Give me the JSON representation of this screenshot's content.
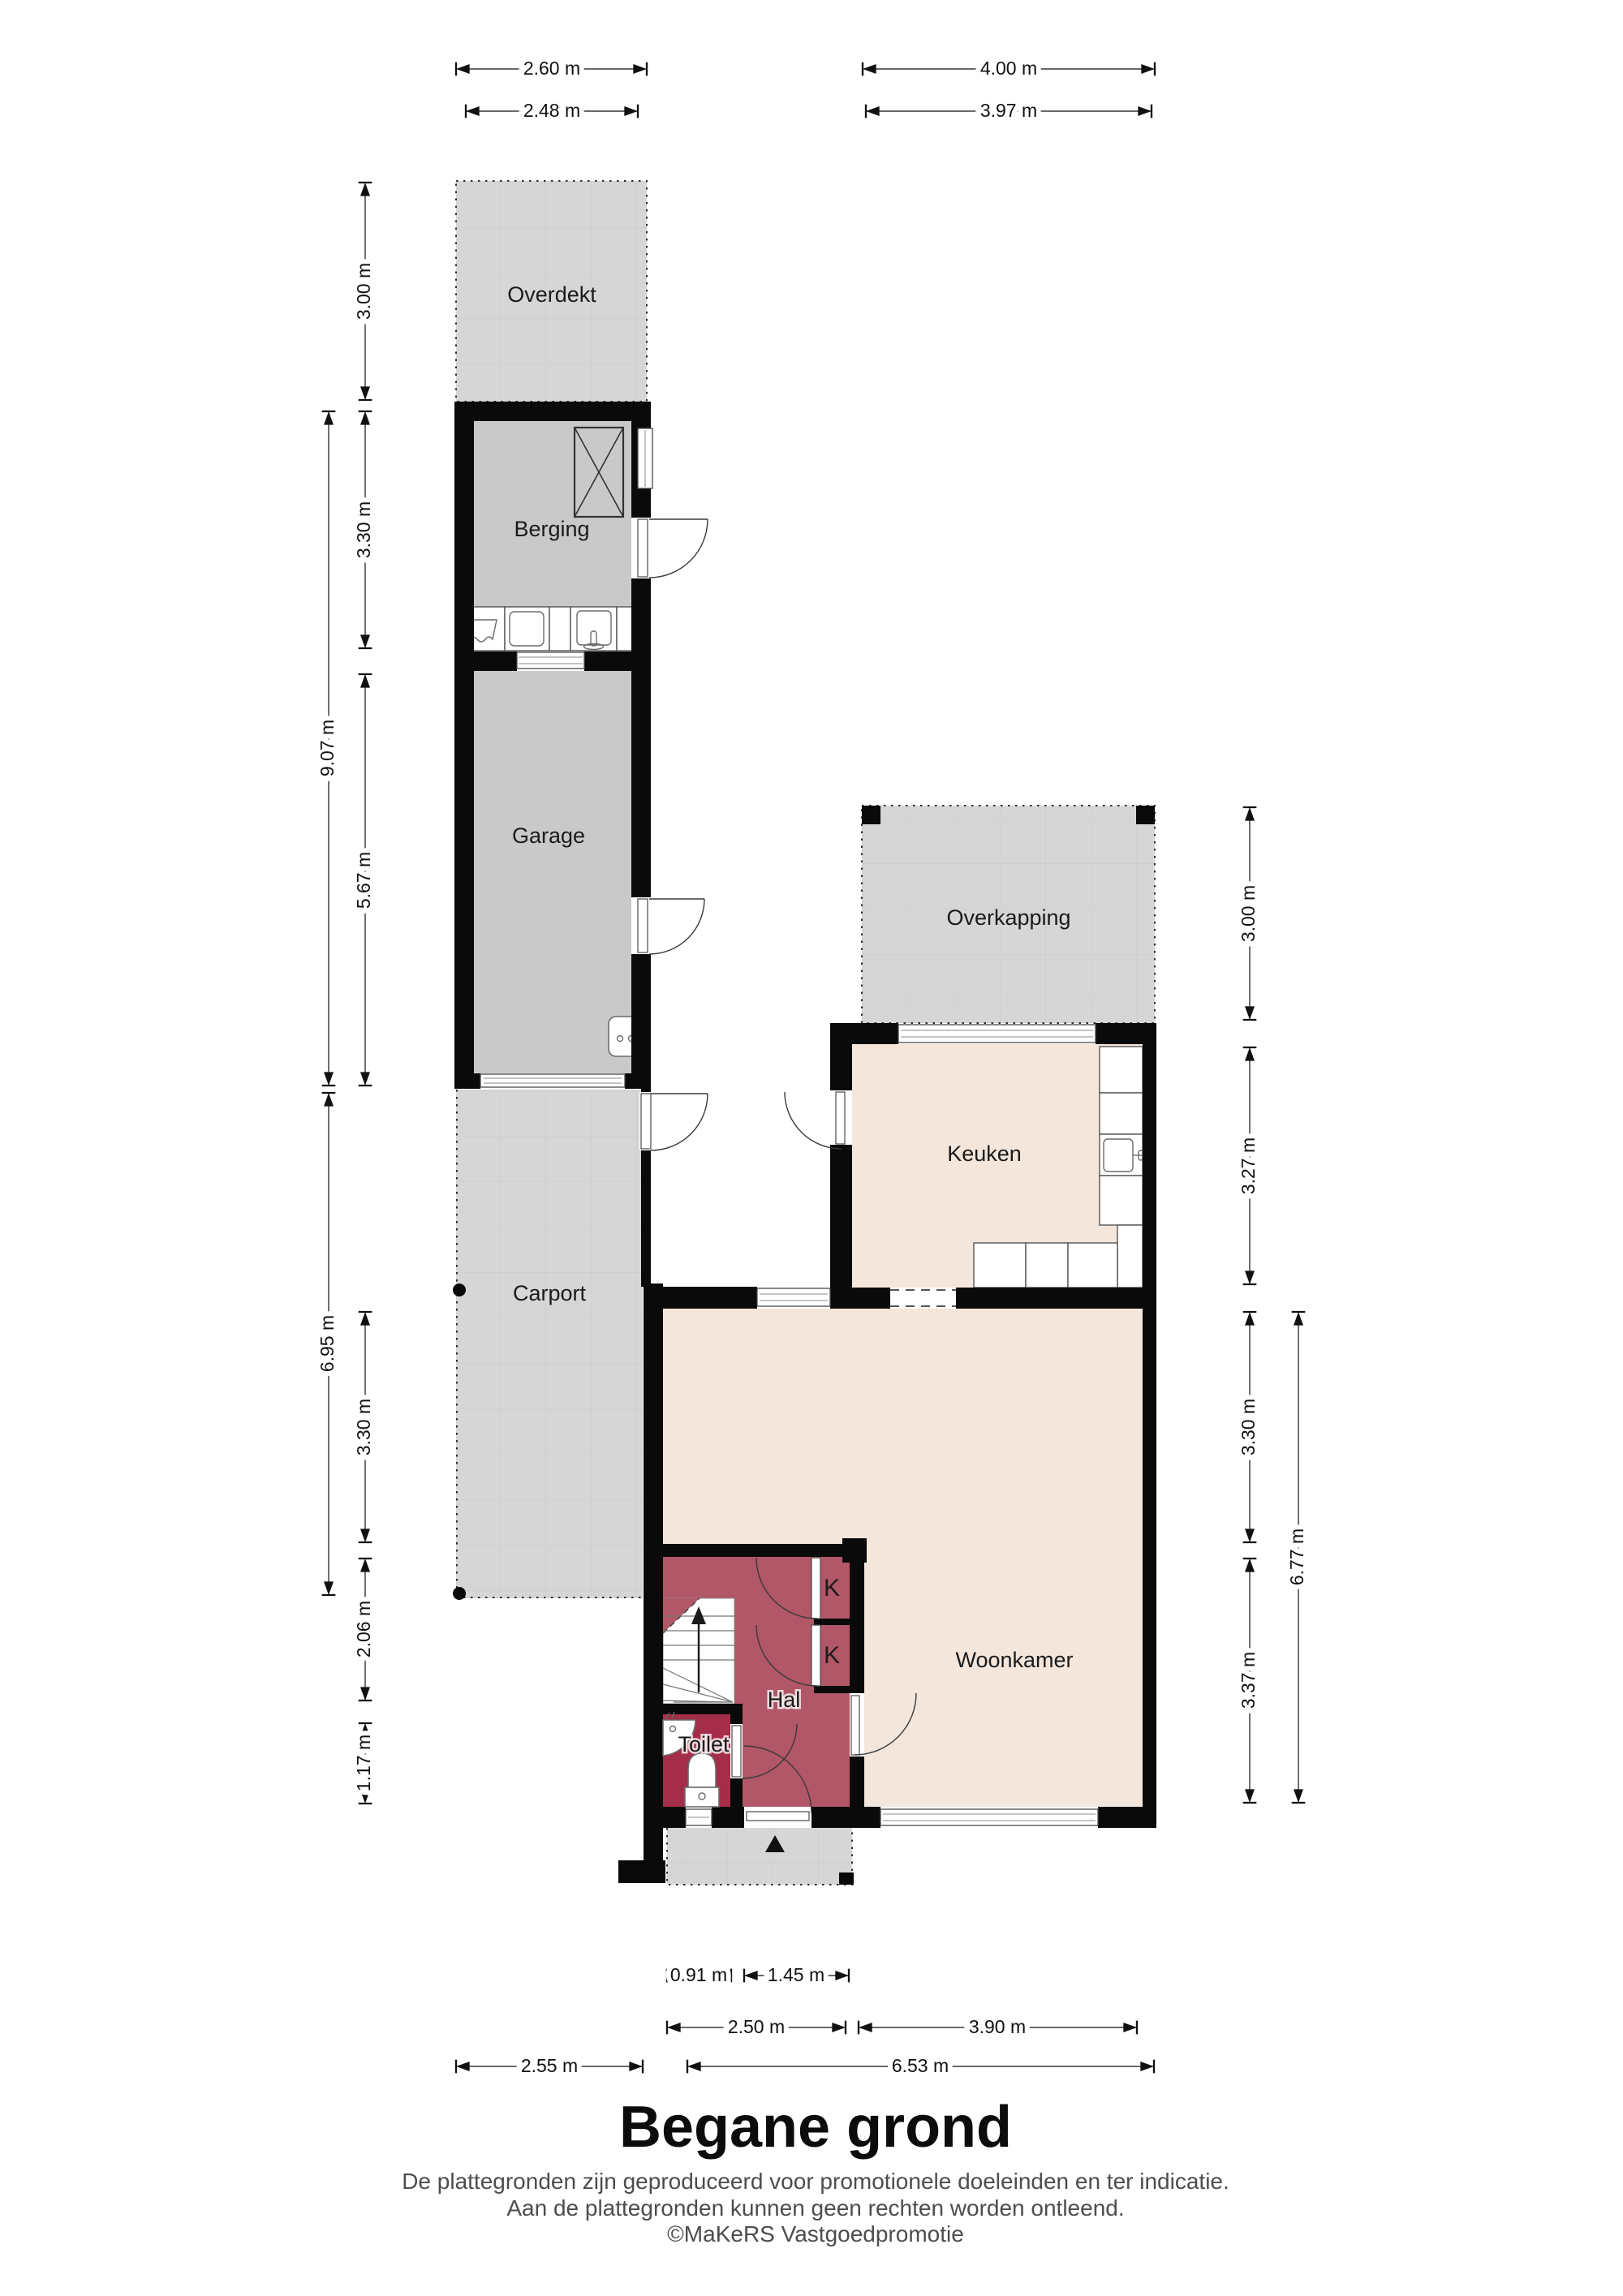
{
  "plan": {
    "title": "Begane grond",
    "footer": [
      "De plattegronden zijn geproduceerd voor promotionele doeleinden en ter indicatie.",
      "Aan de plattegronden kunnen geen rechten worden ontleend.",
      "©MaKeRS Vastgoedpromotie"
    ]
  },
  "rooms": {
    "overdekt": "Overdekt",
    "berging": "Berging",
    "garage": "Garage",
    "carport": "Carport",
    "overkapping": "Overkapping",
    "keuken": "Keuken",
    "woonkamer": "Woonkamer",
    "hal": "Hal",
    "toilet": "Toilet",
    "closet_top": "K",
    "closet_bottom": "K"
  },
  "dims": {
    "top": [
      "2.60 m",
      "2.48 m",
      "4.00 m",
      "3.97 m"
    ],
    "left": [
      "3.00 m",
      "3.30 m",
      "9.07 m",
      "5.67 m",
      "6.95 m",
      "3.30 m",
      "2.06 m",
      "1.17 m"
    ],
    "right": [
      "3.00 m",
      "3.27 m",
      "3.30 m",
      "3.37 m",
      "6.77 m"
    ],
    "bottom": [
      "0.91 m",
      "1.45 m",
      "2.50 m",
      "3.90 m",
      "2.55 m",
      "6.53 m"
    ]
  },
  "colors": {
    "wall": "#0a0a0a",
    "zone_light": "#d6d6d6",
    "interior_gray": "#c9c9c9",
    "beige": "#f4e6db",
    "hal": "#b15767",
    "toilet": "#a42e49",
    "dim_line": "#111111"
  }
}
